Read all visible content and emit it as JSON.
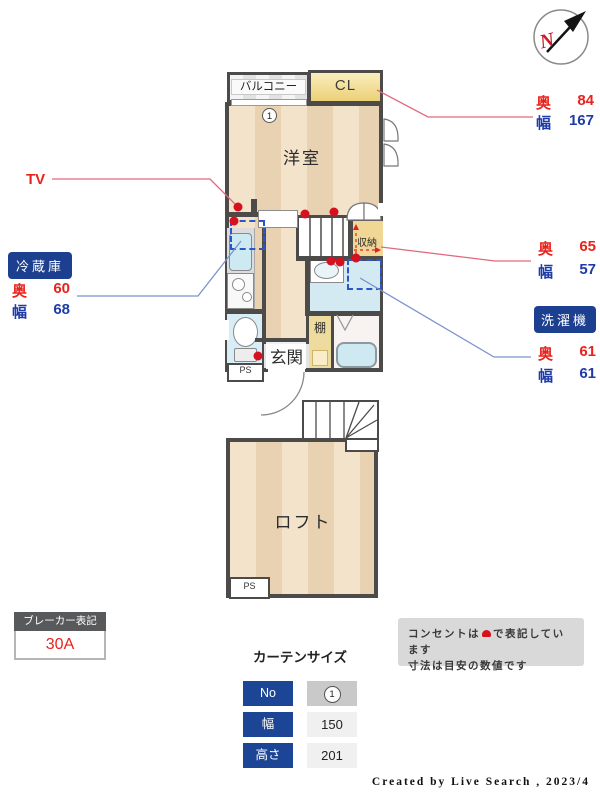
{
  "compass": {
    "north_letter": "N"
  },
  "plan": {
    "balcony_label": "バルコニー",
    "closet_label": "CL",
    "western_room_label": "洋室",
    "storage_label": "収納",
    "entrance_label": "玄関",
    "shelf_label": "棚",
    "loft_label": "ロフト",
    "ps_label_1f": "PS",
    "ps_label_loft": "PS",
    "window_number": "1"
  },
  "annotations": {
    "tv_label": "TV",
    "closet_dim": {
      "depth_label": "奥",
      "depth_value": "84",
      "width_label": "幅",
      "width_value": "167"
    },
    "storage_dim": {
      "depth_label": "奥",
      "depth_value": "65",
      "width_label": "幅",
      "width_value": "57"
    },
    "washer_badge": "洗濯機",
    "washer_dim": {
      "depth_label": "奥",
      "depth_value": "61",
      "width_label": "幅",
      "width_value": "61"
    },
    "fridge_badge": "冷蔵庫",
    "fridge_dim": {
      "depth_label": "奥",
      "depth_value": "60",
      "width_label": "幅",
      "width_value": "68"
    }
  },
  "breaker": {
    "title": "ブレーカー表記",
    "value": "30A"
  },
  "curtain_table": {
    "title": "カーテンサイズ",
    "rows": [
      {
        "label": "No",
        "value": "1"
      },
      {
        "label": "幅",
        "value": "150"
      },
      {
        "label": "高さ",
        "value": "201"
      }
    ]
  },
  "notes": {
    "line1_before": "コンセントは",
    "line1_after": "で表記しています",
    "line2": "寸法は目安の数値です"
  },
  "credit": "Created by Live Search , 2023/4",
  "colors": {
    "accent_red": "#e8231d",
    "accent_blue": "#1e3ca8",
    "badge_blue": "#1d3f8f",
    "wall": "#4c4b49",
    "outlet_red": "#d6101f"
  }
}
